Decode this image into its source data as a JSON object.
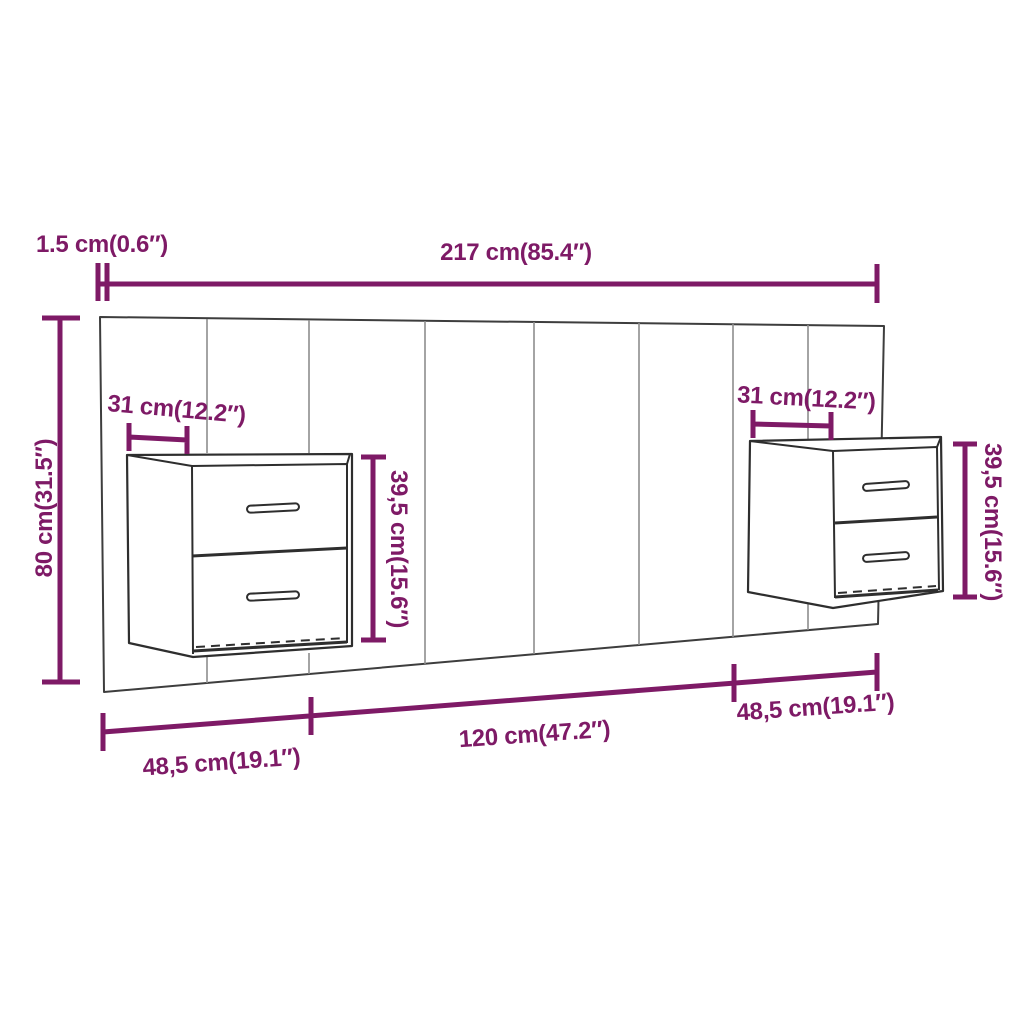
{
  "colors": {
    "dimension": "#7e1a66",
    "outline": "#3d3d3d",
    "seam": "#8d8d8d",
    "furniture": "#2e2e2e"
  },
  "labels": {
    "edge_thickness": "1.5 cm(0.6″)",
    "total_width": "217 cm(85.4″)",
    "total_height": "80 cm(31.5″)",
    "left_nightstand_depth": "31 cm(12.2″)",
    "left_nightstand_height": "39,5 cm(15.6″)",
    "right_nightstand_depth": "31 cm(12.2″)",
    "right_nightstand_height": "39,5 cm(15.6″)",
    "bottom_left_width": "48,5 cm(19.1″)",
    "bottom_center_width": "120 cm(47.2″)",
    "bottom_right_width": "48,5 cm(19.1″)"
  }
}
